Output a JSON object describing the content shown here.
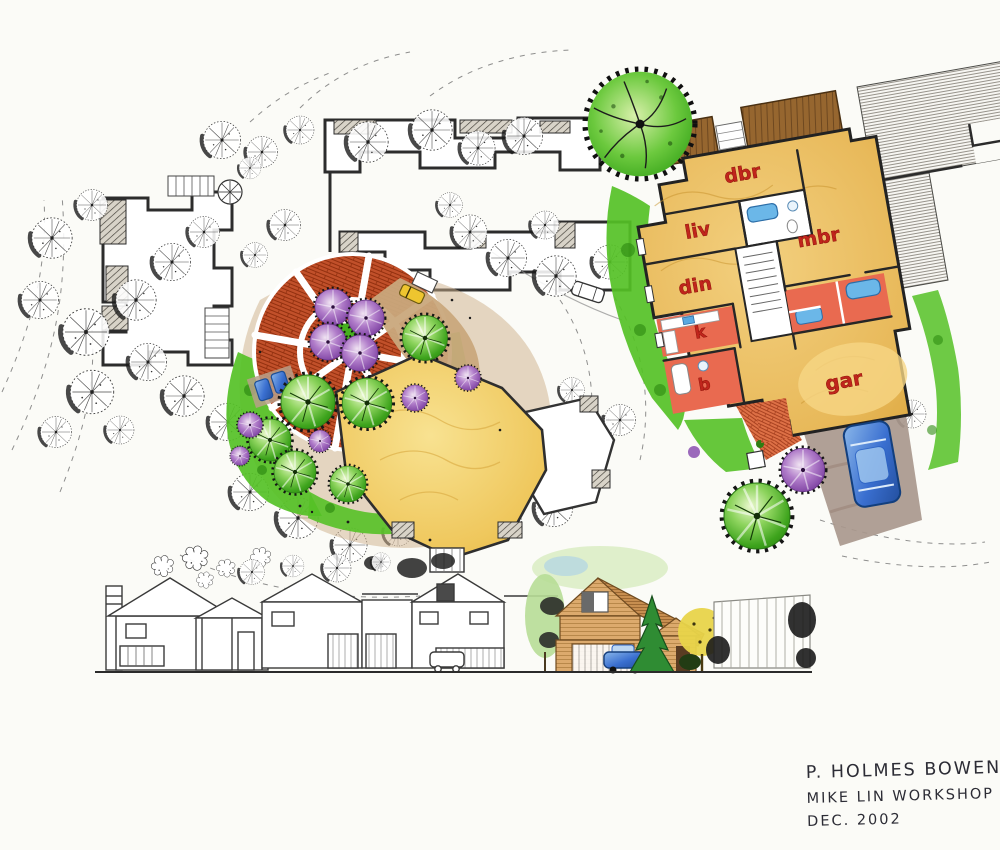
{
  "floor_plan": {
    "rooms": [
      {
        "id": "dbr",
        "label": "dbr"
      },
      {
        "id": "liv",
        "label": "liv"
      },
      {
        "id": "din",
        "label": "din"
      },
      {
        "id": "k",
        "label": "k"
      },
      {
        "id": "b",
        "label": "b"
      },
      {
        "id": "mbr",
        "label": "mbr"
      },
      {
        "id": "gar",
        "label": "gar"
      }
    ]
  },
  "signature": {
    "line1": "P. HOLMES BOWEN",
    "line2": "MIKE LIN WORKSHOP",
    "line3": "DEC. 2002"
  },
  "palette": {
    "paper": "#fbfbf7",
    "ink": "#2b2b2b",
    "plaza_brick": "#c1502a",
    "lawn_green": "#55c126",
    "tree_green": "#3fae1e",
    "tree_purple": "#8a4fb0",
    "floor_wood": "#e8b95a",
    "deck_brown": "#96662f",
    "bath_red": "#e96a50",
    "label_red": "#c0251c",
    "car_blue": "#2c63c4",
    "path_tan": "#c9a87c",
    "driveway": "#a9988d"
  }
}
